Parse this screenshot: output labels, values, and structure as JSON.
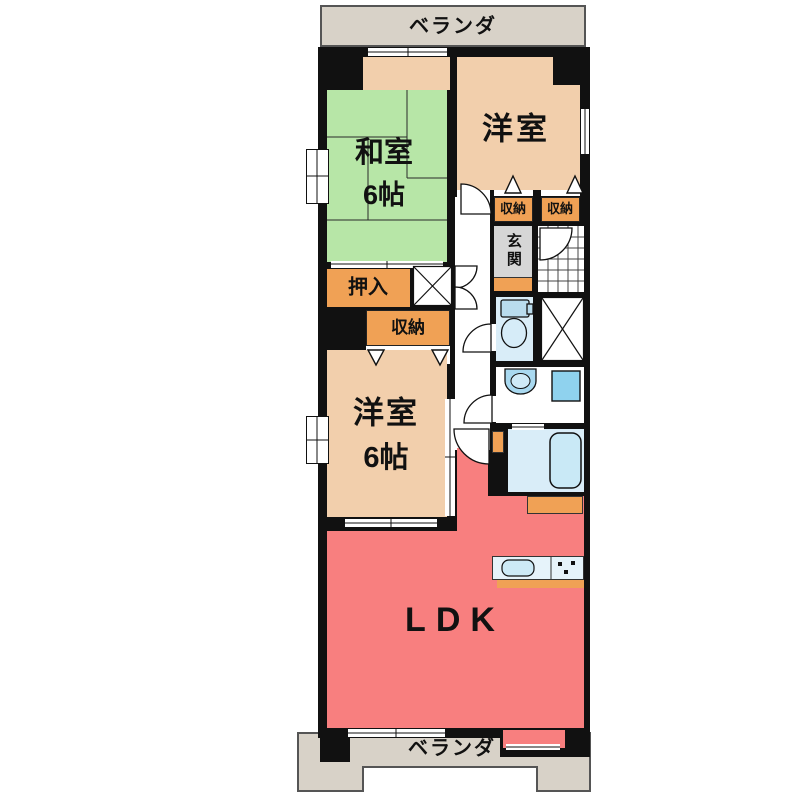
{
  "floorplan": {
    "balcony_top_label": "ベランダ",
    "balcony_bottom_label": "ベランダ",
    "rooms": {
      "washitsu": {
        "name": "和室",
        "size": "6帖"
      },
      "yoshitsu_upper": {
        "name": "洋室"
      },
      "yoshitsu_lower": {
        "name": "洋室",
        "size": "6帖"
      },
      "ldk": {
        "name": "LDK"
      },
      "genkan": {
        "name": "玄関"
      },
      "oshiire": {
        "name": "押入"
      },
      "storage_upper_left": {
        "name": "収納"
      },
      "storage_upper_right": {
        "name": "収納"
      },
      "storage_middle": {
        "name": "収納"
      }
    },
    "colors": {
      "tatami_green": "#b7e6a7",
      "wood_floor": "#f2cfac",
      "storage_orange": "#f0a155",
      "ldk_salmon": "#f87f7f",
      "entry_gray": "#d6d6d6",
      "balcony_gray": "#d8d2c8",
      "water_blue": "#d9edf8",
      "fixture_blue": "#a9d9f0",
      "wall_black": "#111111"
    }
  }
}
